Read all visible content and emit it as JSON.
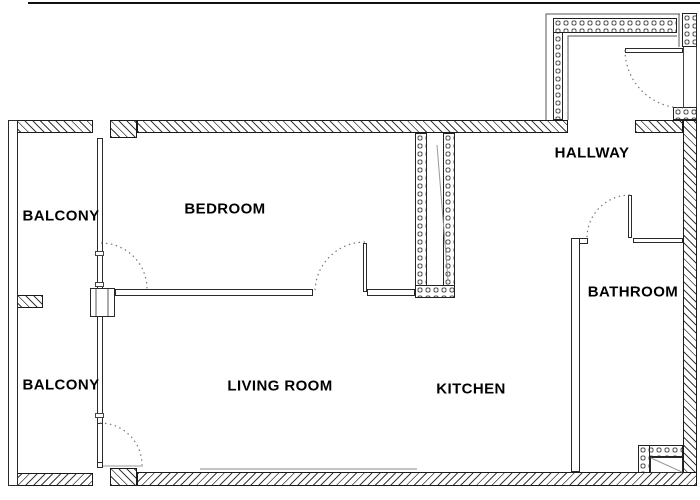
{
  "plan_title": "apartment floor plan",
  "rooms": {
    "balcony_top": {
      "label": "BALCONY"
    },
    "balcony_bottom": {
      "label": "BALCONY"
    },
    "bedroom": {
      "label": "BEDROOM"
    },
    "living_room": {
      "label": "LIVING ROOM"
    },
    "kitchen": {
      "label": "KITCHEN"
    },
    "hallway": {
      "label": "HALLWAY"
    },
    "bathroom": {
      "label": "BATHROOM"
    }
  },
  "colors": {
    "wall_line": "#1a1a1a",
    "stone_pattern": "#555555",
    "label_text": "#000000",
    "faint_sill": "#c4c4c4"
  }
}
